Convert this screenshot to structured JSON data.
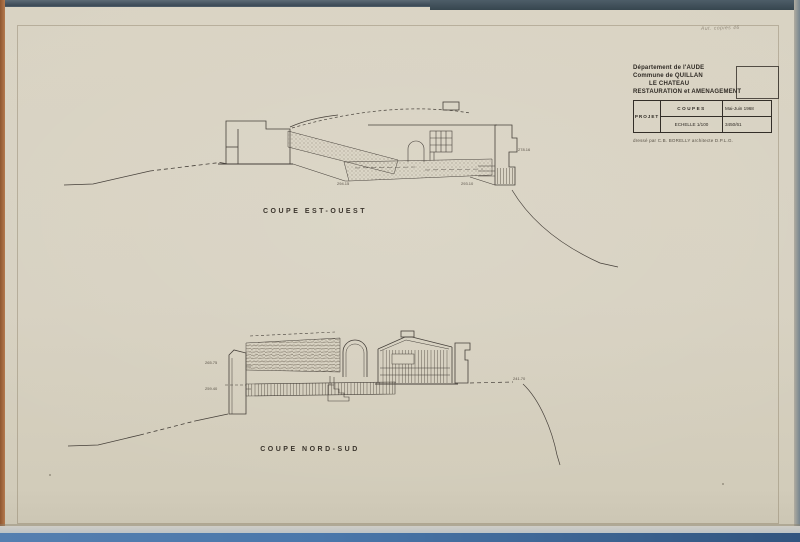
{
  "annotation": {
    "text": "Aut. copies 46"
  },
  "title_block": {
    "line1": "Département de l'AUDE",
    "line2": "Commune de QUILLAN",
    "line3": "LE CHATEAU",
    "line4": "RESTAURATION et AMENAGEMENT",
    "table": {
      "project": "PROJET",
      "drawing": "COUPES",
      "date": "Mai-Juin 1968",
      "scale": "ECHELLE 1/100",
      "number": "3450/61"
    },
    "credit": "dressé par C.B. BORELLY architecte D.P.L.G."
  },
  "sections": {
    "upper": {
      "caption": "COUPE EST-OUEST",
      "labels": {
        "l1": "294.15",
        "l2": "293.10",
        "l3": "278.16"
      }
    },
    "lower": {
      "caption": "COUPE NORD-SUD",
      "labels": {
        "l1": "265.75",
        "l2": "259.40",
        "l3": "241.70"
      }
    }
  },
  "colors": {
    "paper": "#d8d2c2",
    "ink": "#46403a",
    "edge_top": "#3b4a56",
    "edge_left": "#b4794e",
    "edge_right": "#76858f",
    "edge_bottom_blue": "#4a77ab"
  }
}
